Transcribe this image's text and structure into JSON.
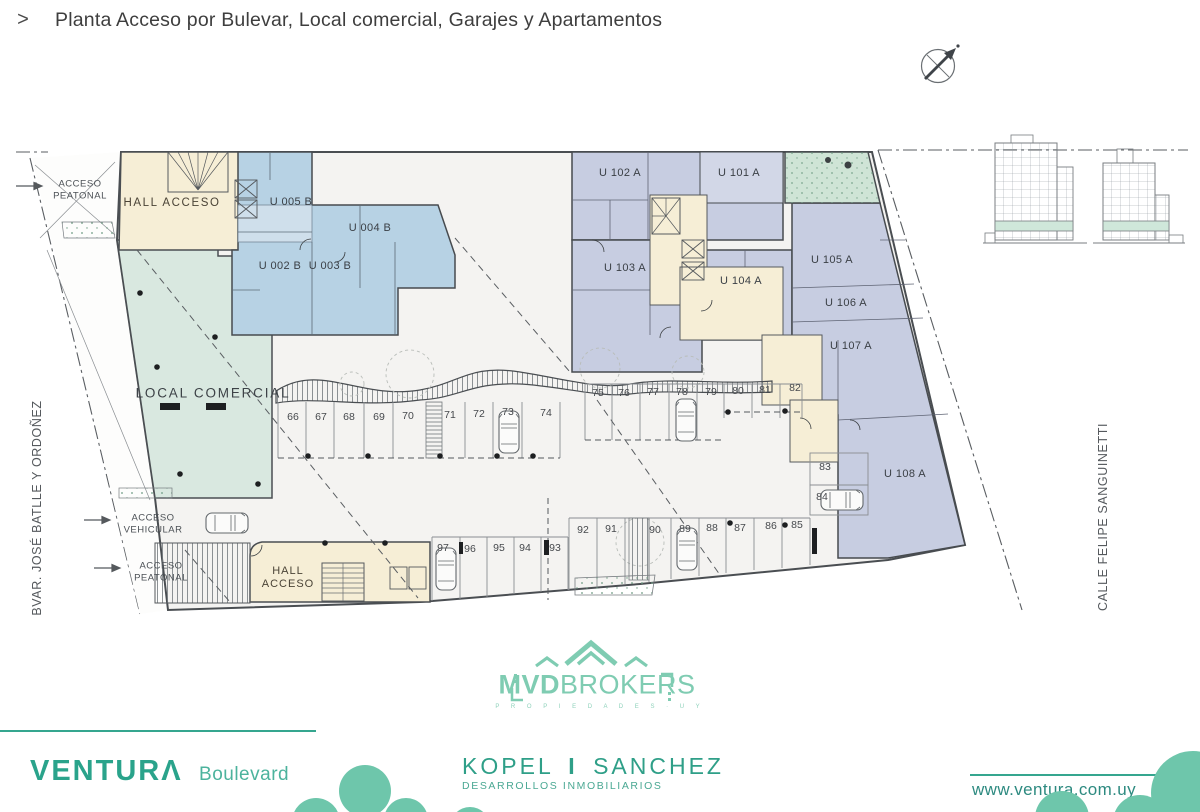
{
  "header": {
    "chevron": ">",
    "title": "Planta Acceso por Bulevar, Local comercial, Garajes y Apartamentos"
  },
  "streets": {
    "left": "BVAR. JOSÉ BATLLE Y ORDOÑEZ",
    "right": "CALLE FELIPE SANGUINETTI"
  },
  "plan": {
    "hall_top": "HALL ACCESO",
    "hall_bottom_1": "HALL",
    "hall_bottom_2": "ACCESO",
    "local_comercial": "LOCAL COMERCIAL",
    "acceso_peatonal_1": "ACCESO",
    "acceso_peatonal_2": "PEATONAL",
    "acceso_vehicular_1": "ACCESO",
    "acceso_vehicular_2": "VEHICULAR",
    "units_b": [
      "U 005 B",
      "U 004 B",
      "U 002 B",
      "U 003 B"
    ],
    "units_a": [
      "U 102 A",
      "U 101 A",
      "U 103 A",
      "U 104 A",
      "U 105 A",
      "U 106 A",
      "U 107 A",
      "U 108 A"
    ],
    "parking": [
      "66",
      "67",
      "68",
      "69",
      "70",
      "71",
      "72",
      "73",
      "74",
      "75",
      "76",
      "77",
      "78",
      "79",
      "80",
      "81",
      "82",
      "83",
      "84",
      "85",
      "86",
      "87",
      "88",
      "89",
      "90",
      "91",
      "92",
      "93",
      "94",
      "95",
      "96",
      "97"
    ]
  },
  "branding": {
    "mvd": {
      "bold": "MVD",
      "rest": "BROKERS",
      "tagline": "P R O P I E D A D E S · U Y"
    },
    "ventura": {
      "name": "VENTURΛ",
      "sub": "Boulevard"
    },
    "kopel": {
      "left": "KOPEL",
      "divider": "I",
      "right": "SANCHEZ",
      "sub": "DESARROLLOS INMOBILIARIOS"
    },
    "website": "www.ventura.com.uy"
  },
  "colors": {
    "teal_brand": "#35a68f",
    "mvd_logo": "#7fccb2",
    "unit_blue": "#b7d2e4",
    "unit_lavender": "#c7cde1",
    "local_mint": "#d9e8e0",
    "hall_cream": "#f6eed6",
    "terrace_green": "#cfe4d6"
  }
}
